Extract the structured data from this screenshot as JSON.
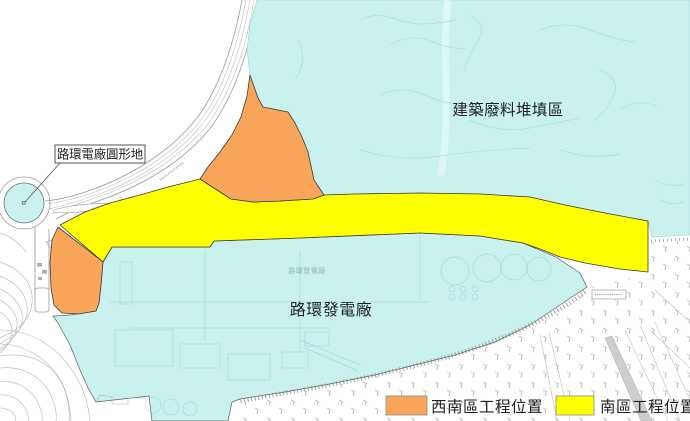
{
  "map": {
    "labels": {
      "landfill": "建築廢料堆填區",
      "roundabout": "路環電廠圓形地",
      "power_plant": "路環發電廠",
      "power_plant_small": "路環發電廠"
    }
  },
  "legend": {
    "items": [
      {
        "label": "西南區工程位置",
        "color": "#F9A65B"
      },
      {
        "label": "南區工程位置",
        "color": "#FFFF00"
      }
    ]
  },
  "colors": {
    "cyan": "#C9F2EF",
    "orange": "#F9A65B",
    "yellow": "#FFFF00",
    "outline": "#3a3a3a"
  }
}
